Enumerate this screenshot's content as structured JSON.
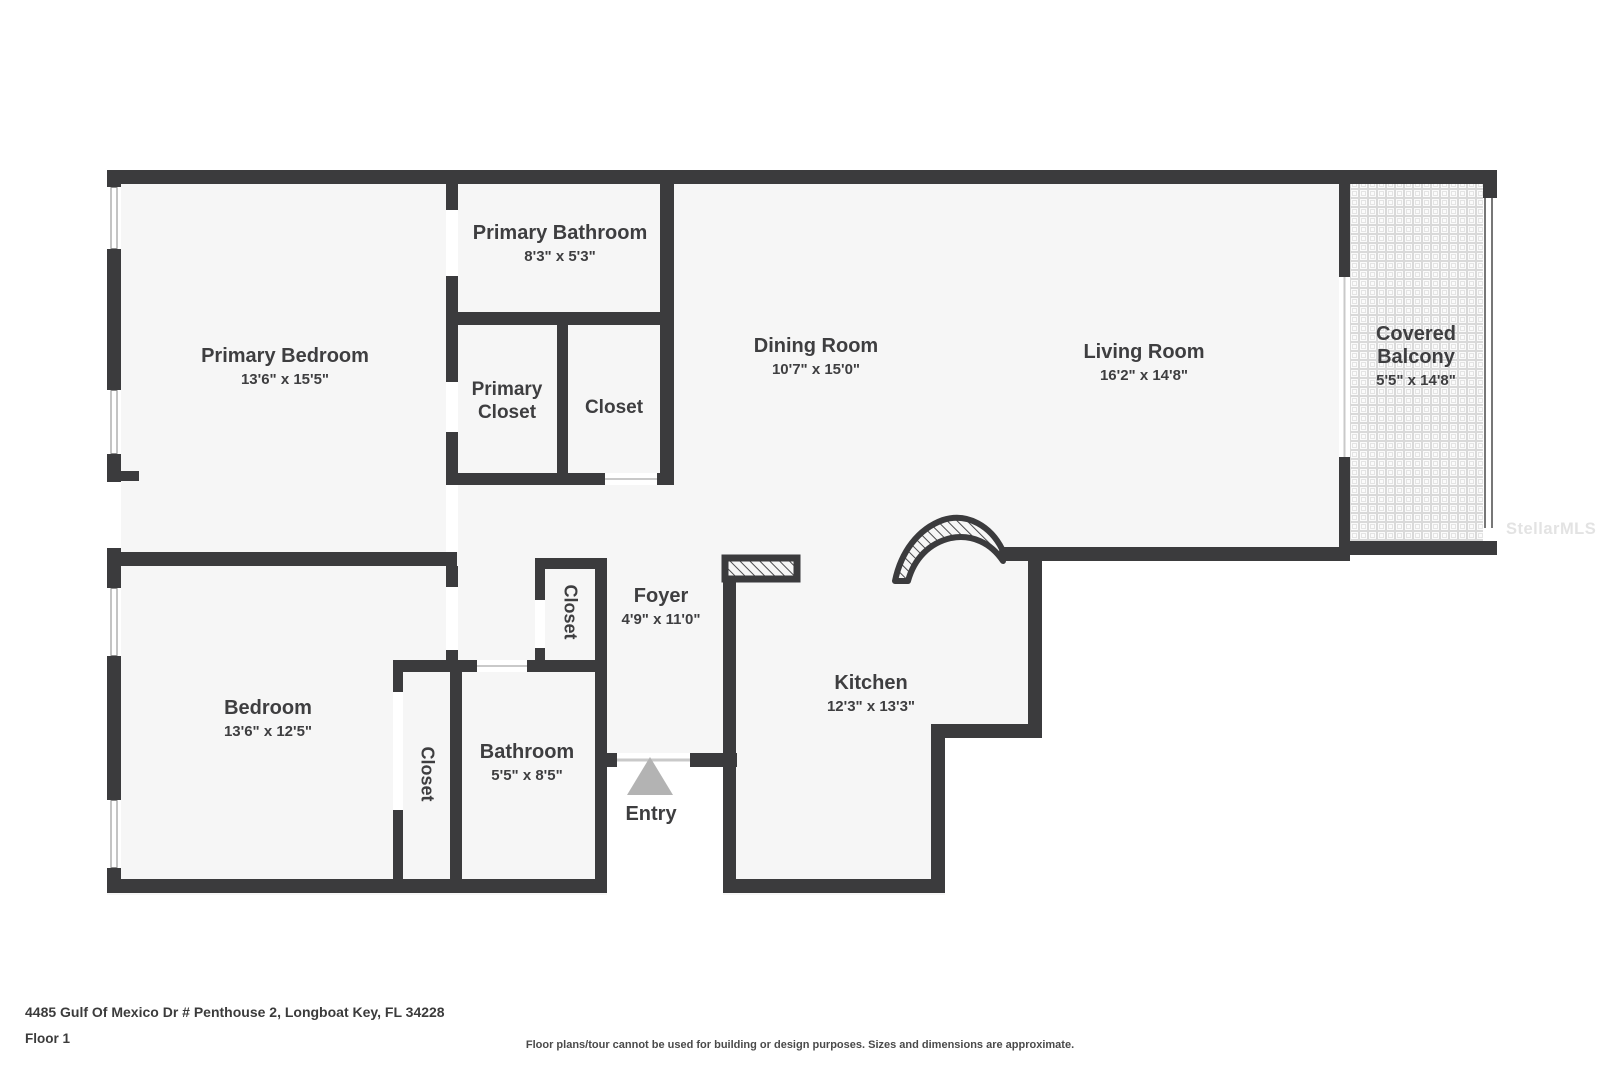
{
  "meta": {
    "address": "4485 Gulf Of Mexico Dr # Penthouse 2, Longboat Key, FL 34228",
    "floor_label": "Floor 1",
    "disclaimer": "Floor plans/tour cannot be used for building or design purposes. Sizes and dimensions are approximate.",
    "watermark": "StellarMLS"
  },
  "rooms": {
    "primary_bedroom": {
      "name": "Primary Bedroom",
      "dims": "13'6\" x 15'5\""
    },
    "primary_bathroom": {
      "name": "Primary Bathroom",
      "dims": "8'3\" x 5'3\""
    },
    "primary_closet": {
      "line1": "Primary",
      "line2": "Closet"
    },
    "closet_top": {
      "name": "Closet"
    },
    "dining_room": {
      "name": "Dining Room",
      "dims": "10'7\" x 15'0\""
    },
    "living_room": {
      "name": "Living Room",
      "dims": "16'2\" x 14'8\""
    },
    "covered_balcony": {
      "line1": "Covered",
      "line2": "Balcony",
      "dims": "5'5\" x 14'8\""
    },
    "foyer": {
      "name": "Foyer",
      "dims": "4'9\" x 11'0\""
    },
    "kitchen": {
      "name": "Kitchen",
      "dims": "12'3\" x 13'3\""
    },
    "bedroom": {
      "name": "Bedroom",
      "dims": "13'6\" x 12'5\""
    },
    "bathroom": {
      "name": "Bathroom",
      "dims": "5'5\" x 8'5\""
    },
    "closet_bedroom": {
      "name": "Closet"
    },
    "closet_foyer": {
      "name": "Closet"
    },
    "entry": {
      "name": "Entry"
    }
  },
  "colors": {
    "wall": "#3b3b3d",
    "floor": "#f6f6f6",
    "text": "#3e3e40",
    "entry_arrow": "#b3b3b3",
    "watermark": "#e3e3e3",
    "window_line": "#8a8a8a",
    "door_line": "#c9c9c9",
    "balcony_tile_line": "#d9d9d9",
    "hatch_line": "#4a4a4c"
  }
}
